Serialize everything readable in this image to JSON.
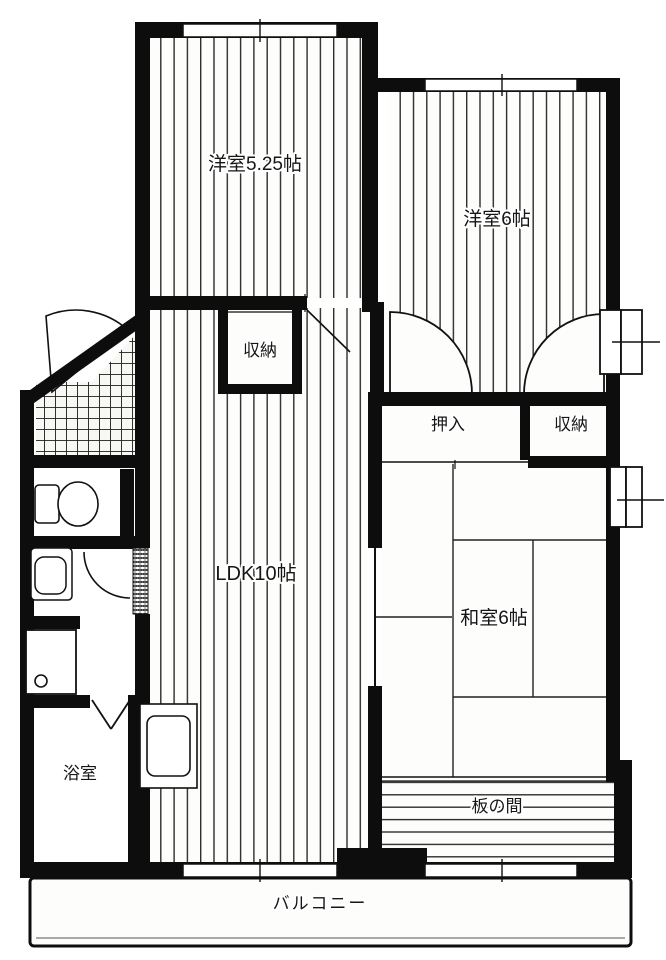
{
  "floorplan": {
    "colors": {
      "background": "#ffffff",
      "wall": "#0d0d0d",
      "floor_line": "#2e2e2e"
    },
    "rooms": {
      "western_525": {
        "label": "洋室5.25帖"
      },
      "western_6": {
        "label": "洋室6帖"
      },
      "closet_top": {
        "label": "収納"
      },
      "oshiire": {
        "label": "押入"
      },
      "closet_right": {
        "label": "収納"
      },
      "ldk": {
        "label": "LDK10帖"
      },
      "washitsu": {
        "label": "和室6帖"
      },
      "itanoma": {
        "label": "板の間"
      },
      "bathroom": {
        "label": "浴室"
      },
      "balcony": {
        "label": "バルコニー"
      }
    }
  }
}
